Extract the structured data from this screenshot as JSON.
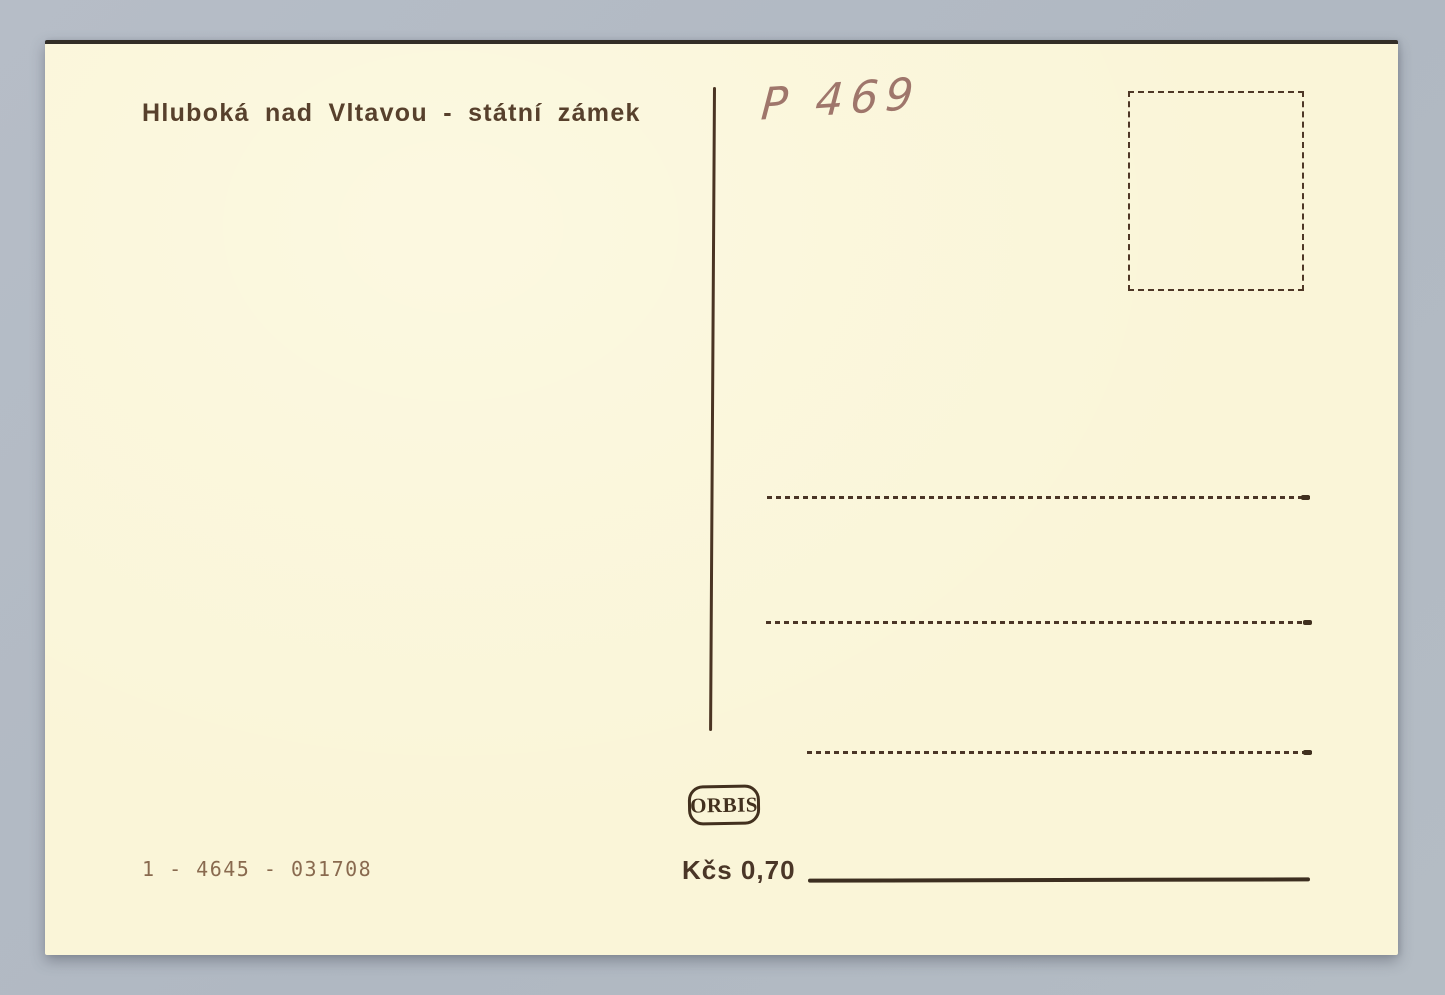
{
  "postcard": {
    "title": "Hluboká nad Vltavou - státní zámek",
    "handwritten_code": "P 469",
    "publisher": "ORBIS",
    "serial_number": "1 - 4645 - 031708",
    "price": "Kčs 0,70"
  },
  "colors": {
    "background": "#b2bac4",
    "card": "#faf5d8",
    "ink": "#4a3526",
    "ink_faded": "#7d5c41",
    "pencil": "#8f6058"
  }
}
